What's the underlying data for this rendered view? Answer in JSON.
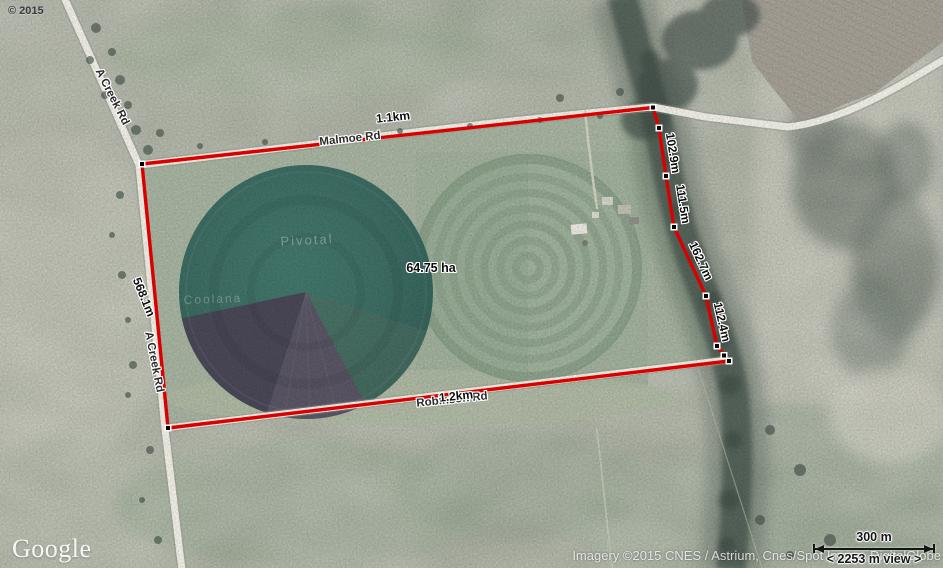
{
  "watermarks": {
    "top_left_copyright": "© 2015",
    "logo_text": "Google",
    "imagery_credit": "Imagery ©2015 CNES / Astrium, Cnes/Spot Image, DigitalGlobe"
  },
  "scale_bar": {
    "distance_label": "300 m",
    "view_width_label": "< 2253 m view >"
  },
  "measurement": {
    "area_label": "64.75 ha",
    "side_top": "1.1km",
    "side_left": "568.1m",
    "side_bottom": "1.2km",
    "creek_seg_1": "102.9m",
    "creek_seg_2": "111.5m",
    "creek_seg_3": "162.7m",
    "creek_seg_4": "112.4m"
  },
  "roads": {
    "a_creek_rd_north": "A Creek Rd",
    "a_creek_rd_south": "A Creek Rd",
    "malmoe_rd": "Malmoe Rd",
    "robinson_rd": "Robinson Rd"
  },
  "place_labels": {
    "pivot_field": "Pivotal",
    "lower_field": "Coolana"
  },
  "colors": {
    "measure_line": "#db0000",
    "vertex_fill": "#000000",
    "vertex_border": "#ffffff",
    "road_fill": "#f4f3ea",
    "pivot_teal": "#3f7066",
    "pivot_wedge_dark": "#4b4959",
    "pivot_wedge_mid": "#5b5766",
    "pivot_rings_field": "#9cb09b",
    "creek_trees": "#4a584f",
    "label_text": "#0c0c0c",
    "label_halo": "#ffffff"
  }
}
